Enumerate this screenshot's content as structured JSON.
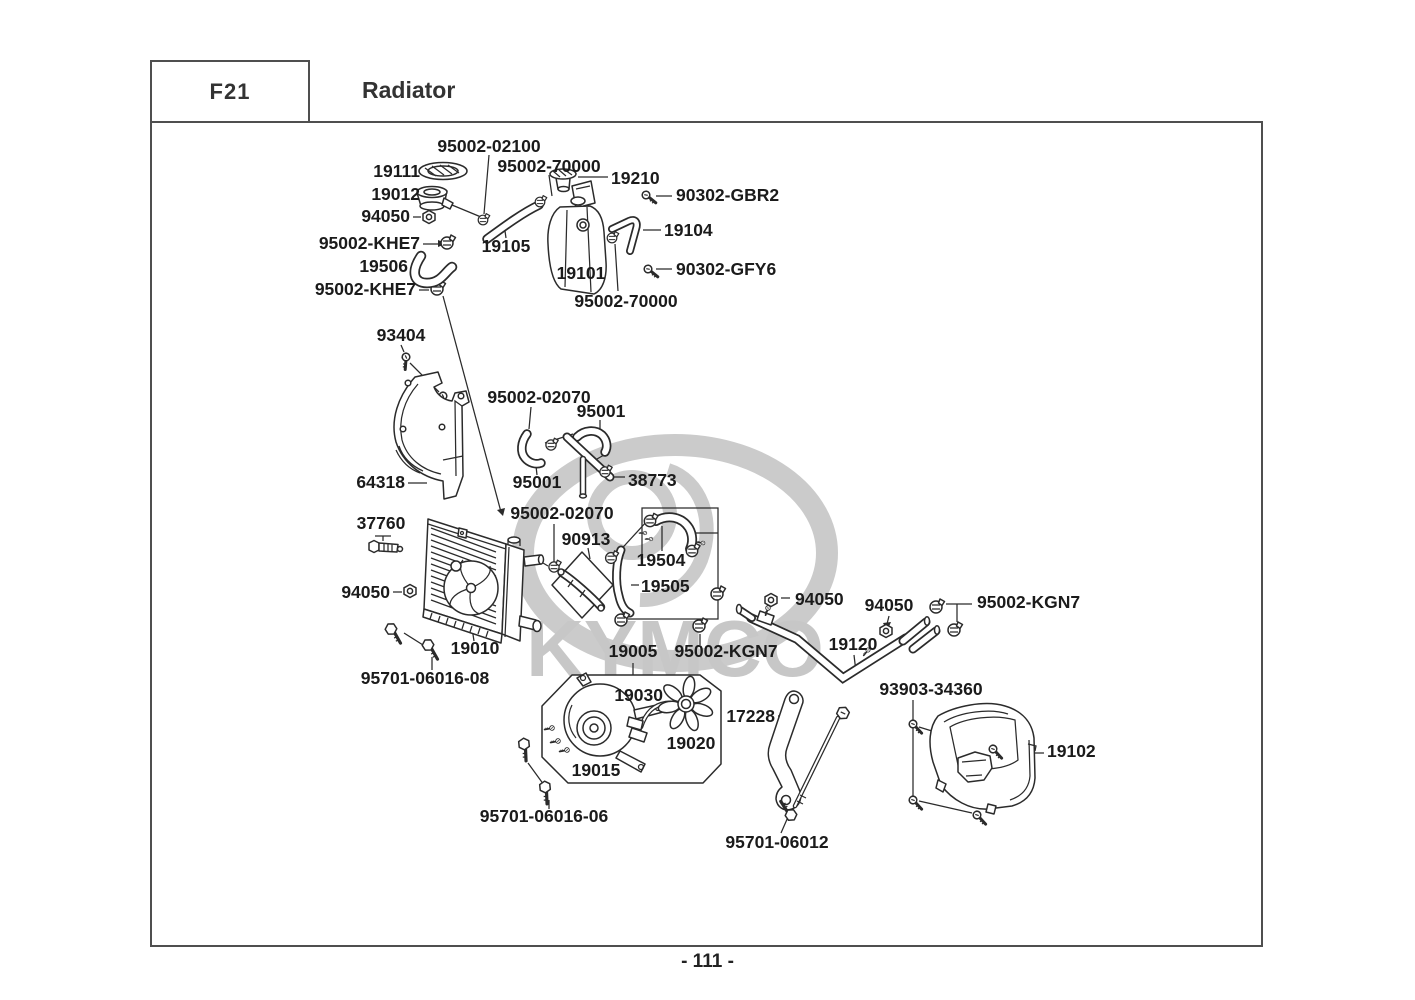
{
  "header": {
    "section_code": "F21",
    "title": "Radiator"
  },
  "footer": {
    "page_number": "- 111 -"
  },
  "watermark": {
    "brand": "KYMCO",
    "color": "#c9c9c9"
  },
  "diagram": {
    "part_numbers": {
      "p95002_02100": "95002-02100",
      "p19111": "19111",
      "p95002_70000": "95002-70000",
      "p19210": "19210",
      "p90302_gbr2": "90302-GBR2",
      "p19012": "19012",
      "p94050": "94050",
      "p95002_khe7": "95002-KHE7",
      "p19104": "19104",
      "p19506": "19506",
      "p19105": "19105",
      "p19101": "19101",
      "p90302_gfy6": "90302-GFY6",
      "p93404": "93404",
      "p64318": "64318",
      "p95002_02070": "95002-02070",
      "p95001": "95001",
      "p38773": "38773",
      "p37760": "37760",
      "p90913": "90913",
      "p19504": "19504",
      "p19505": "19505",
      "p19010": "19010",
      "p95701_06016_08": "95701-06016-08",
      "p19005": "19005",
      "p95002_kgn7": "95002-KGN7",
      "p19120": "19120",
      "p19030": "19030",
      "p17228": "17228",
      "p19020": "19020",
      "p93903_34360": "93903-34360",
      "p19015": "19015",
      "p19102": "19102",
      "p95701_06016_06": "95701-06016-06",
      "p95701_06012": "95701-06012"
    }
  }
}
